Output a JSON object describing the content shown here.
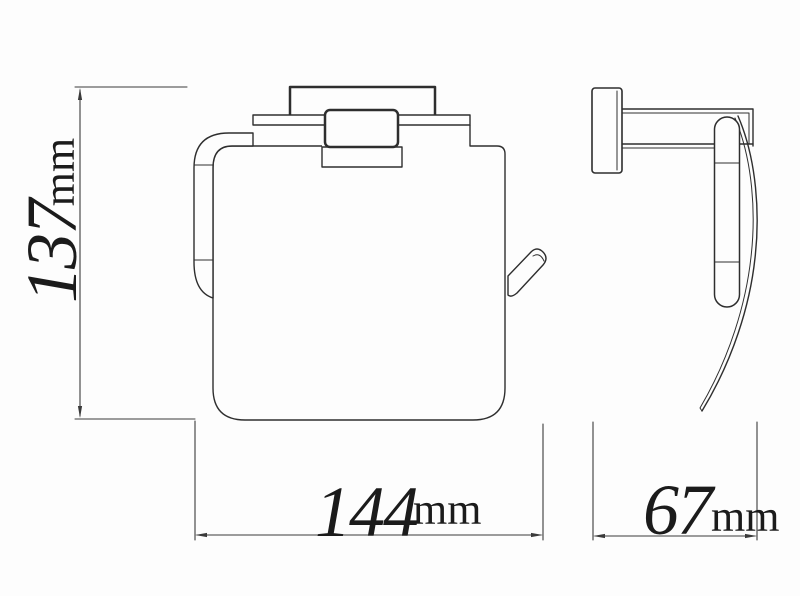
{
  "colors": {
    "background": "#fdfdfd",
    "line": "#2e2e2e",
    "dimension_line": "#3a3a3a",
    "text": "#1b1b1b"
  },
  "drawing": {
    "object": "wall-mounted-toilet-paper-holder-with-cover",
    "dimensions": {
      "height": {
        "value": "137",
        "unit": "mm"
      },
      "width": {
        "value": "144",
        "unit": "mm"
      },
      "depth": {
        "value": "67",
        "unit": "mm"
      }
    }
  }
}
